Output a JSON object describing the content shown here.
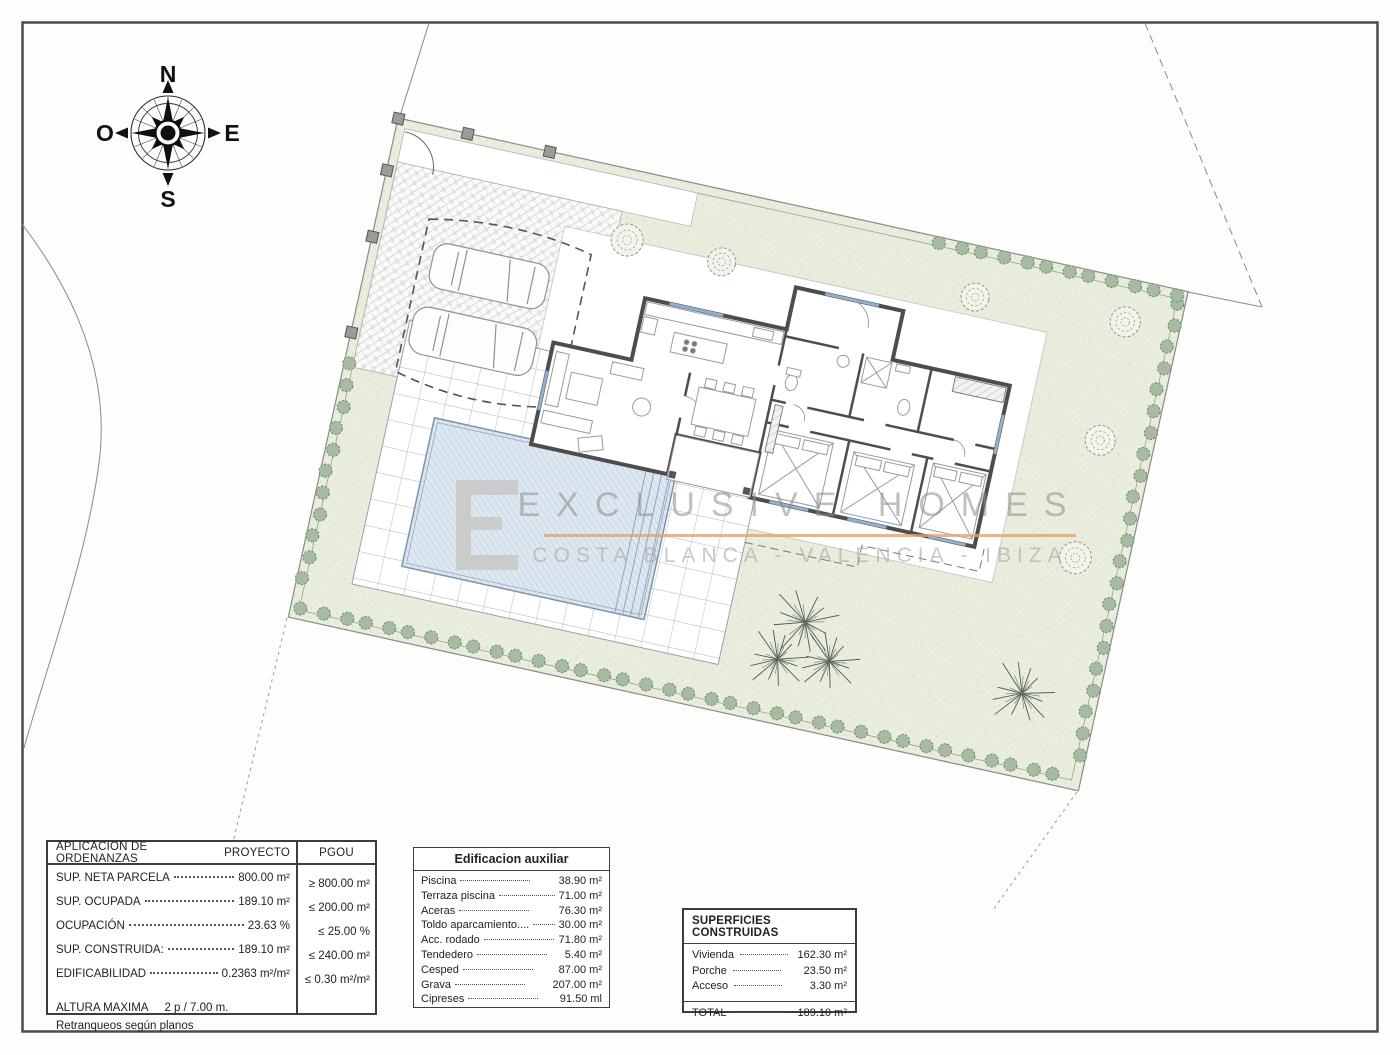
{
  "compass": {
    "north": "N",
    "south": "S",
    "east": "E",
    "west": "O"
  },
  "watermark": {
    "title": "EXCLUSIVE HOMES",
    "subtitle": "COSTA BLANCA  -  VALENCIA  -  IBIZA",
    "accent_color": "#e99f63",
    "text_color": "#8c8c89"
  },
  "tables": {
    "ordenanzas": {
      "col1_header": "APLICACION DE ORDENANZAS",
      "col2_header": "PROYECTO",
      "col3_header": "PGOU",
      "rows": [
        {
          "label": "SUP. NETA PARCELA",
          "proyecto": "800.00 m²",
          "pgou": "≥ 800.00 m²"
        },
        {
          "label": "SUP. OCUPADA",
          "proyecto": "189.10 m²",
          "pgou": "≤ 200.00 m²"
        },
        {
          "label": "OCUPACIÓN",
          "proyecto": "23.63 %",
          "pgou": "≤ 25.00 %"
        },
        {
          "label": "SUP. CONSTRUIDA:",
          "proyecto": "189.10 m²",
          "pgou": "≤ 240.00 m²"
        },
        {
          "label": "EDIFICABILIDAD",
          "proyecto": "0.2363 m²/m²",
          "pgou": "≤ 0.30 m²/m²"
        }
      ],
      "altura_label": "ALTURA MAXIMA",
      "altura_value": "2 p  / 7.00 m.",
      "footnote": "Retranqueos según planos"
    },
    "auxiliar": {
      "title": "Edificacion auxiliar",
      "rows": [
        {
          "label": "Piscina",
          "value": "38.90 m²"
        },
        {
          "label": "Terraza piscina",
          "value": "71.00 m²"
        },
        {
          "label": "Aceras",
          "value": "76.30 m²"
        },
        {
          "label": "Toldo aparcamiento....",
          "value": "30.00 m²"
        },
        {
          "label": "Acc. rodado",
          "value": "71.80 m²"
        },
        {
          "label": "Tendedero",
          "value": "5.40 m²"
        },
        {
          "label": "Cesped",
          "value": "87.00 m²"
        },
        {
          "label": "Grava",
          "value": "207.00 m²"
        },
        {
          "label": "Cipreses",
          "value": "91.50 ml"
        }
      ]
    },
    "superficies": {
      "title": "SUPERFICIES CONSTRUIDAS",
      "rows": [
        {
          "label": "Vivienda",
          "value": "162.30 m²"
        },
        {
          "label": "Porche",
          "value": "23.50 m²"
        },
        {
          "label": "Acceso",
          "value": "3.30 m²"
        }
      ],
      "total_label": "TOTAL",
      "total_value": "189.10 m²"
    }
  }
}
